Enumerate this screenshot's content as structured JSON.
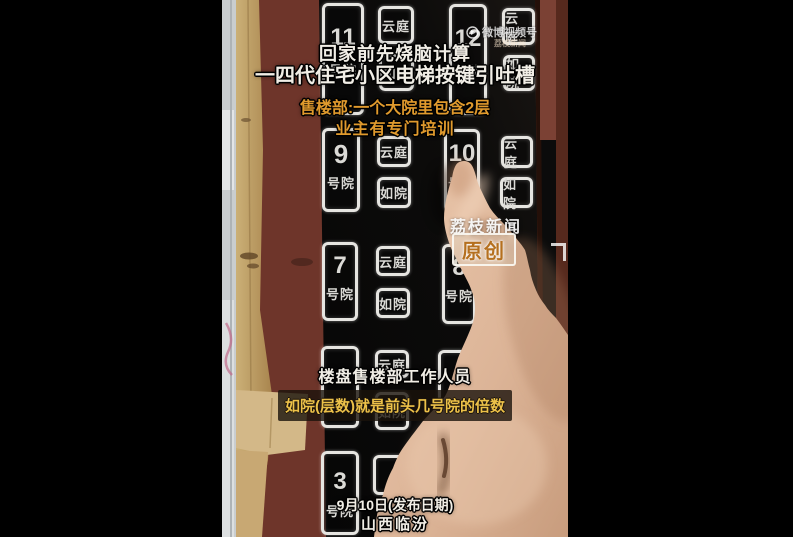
{
  "video": {
    "overlays": {
      "title_line1": "回家前先烧脑计算",
      "title_line2": "一四代住宅小区电梯按键引吐槽",
      "subtitle_line1": "售楼部:一个大院里包含2层",
      "subtitle_line2": "业主有专门培训",
      "speaker_caption": "楼盘售楼部工作人员",
      "quote_caption": "如院(层数)就是前头几号院的倍数",
      "date_caption": "9月10日(发布日期)",
      "location_caption": "山西临汾"
    },
    "watermarks": {
      "platform": "微博视频号",
      "platform_account": "荔枝新闻",
      "channel": "荔枝新闻",
      "original_badge": "原创"
    },
    "panel": {
      "tall_buttons": [
        {
          "num": "11",
          "suffix": "号院"
        },
        {
          "num": "12",
          "suffix": "号院"
        },
        {
          "num": "9",
          "suffix": "号院"
        },
        {
          "num": "10",
          "suffix": "号院"
        },
        {
          "num": "7",
          "suffix": "号院"
        },
        {
          "num": "8",
          "suffix": "号院"
        },
        {
          "num": "",
          "suffix": ""
        },
        {
          "num": "",
          "suffix": ""
        },
        {
          "num": "3",
          "suffix": "号院"
        }
      ],
      "small_button_labels": {
        "yunting": "云庭",
        "ruyuan": "如院"
      }
    },
    "colors": {
      "wall_maroon": "#6e352a",
      "panel_black": "#0b0b0b",
      "button_border": "#e6e5e1",
      "overlay_orange": "#e09a2d",
      "caption_yellow": "#ecc149",
      "skin": "#ddb99e",
      "wood": "#bd9a60"
    }
  }
}
